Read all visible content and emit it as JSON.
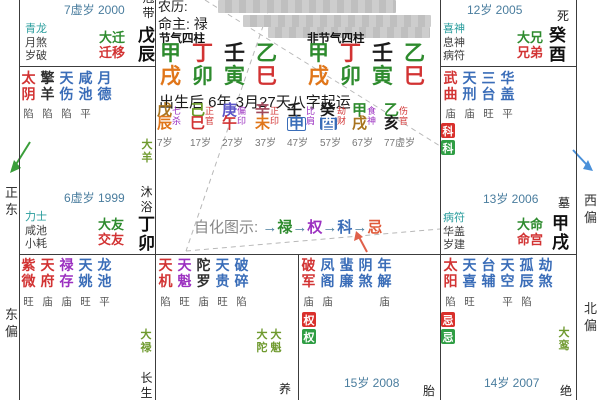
{
  "center": {
    "lunar_label": "农历:",
    "life_master": "命主: 禄",
    "jieqi_header": "节气四柱",
    "non_jieqi_header": "非节气四柱",
    "pillar_stems": [
      "甲",
      "丁",
      "壬",
      "乙"
    ],
    "pillar_branches": [
      "戌",
      "卯",
      "寅",
      "巳"
    ],
    "qiyun_text": "出生后 6年 3月27天八字起运",
    "zihua_label": "自化图示:",
    "arrow": "→",
    "zihua_flow": [
      "禄",
      "权",
      "科",
      "忌"
    ],
    "dayun": [
      {
        "stem": "戊",
        "branch": "辰",
        "god": "七杀",
        "age": "7岁"
      },
      {
        "stem": "己",
        "branch": "巳",
        "god": "正官",
        "age": "17岁"
      },
      {
        "stem": "庚",
        "branch": "午",
        "god": "偏印",
        "age": "27岁"
      },
      {
        "stem": "辛",
        "branch": "未",
        "god": "正印",
        "age": "37岁"
      },
      {
        "stem": "壬",
        "branch": "申",
        "god": "比肩",
        "age": "47岁"
      },
      {
        "stem": "癸",
        "branch": "酉",
        "god": "劫财",
        "age": "57岁"
      },
      {
        "stem": "甲",
        "branch": "戌",
        "god": "食神",
        "age": "67岁"
      },
      {
        "stem": "乙",
        "branch": "亥",
        "god": "伤官",
        "age": "77虚岁"
      }
    ]
  },
  "palaces": {
    "qianyi": {
      "year": "7虚岁 2000",
      "stage": "冠带",
      "gods": [
        "青龙",
        "月煞",
        "岁破"
      ],
      "da": "大迁",
      "name": "迁移",
      "ganzhi": "戊辰"
    },
    "xiongdi": {
      "year": "12岁 2005",
      "stage": "死",
      "gods": [
        "喜神",
        "息神",
        "病符"
      ],
      "da": "大兄",
      "name": "兄弟",
      "ganzhi": "癸酉"
    },
    "jiaoyou": {
      "stars": [
        {
          "n": "太阴",
          "s": "陷"
        },
        {
          "n": "擎羊",
          "s": "陷"
        },
        {
          "n": "天伤",
          "s": "陷"
        },
        {
          "n": "咸池",
          "s": "平"
        },
        {
          "n": "月德",
          "s": ""
        }
      ],
      "flow": "大羊",
      "stage": "沐浴",
      "year": "6虚岁 1999",
      "gods": [
        "力士",
        "咸池",
        "小耗"
      ],
      "da": "大友",
      "name": "交友",
      "ganzhi": "丁卯"
    },
    "ming": {
      "stars": [
        {
          "n": "武曲",
          "s": "庙"
        },
        {
          "n": "天刑",
          "s": "庙"
        },
        {
          "n": "三台",
          "s": "旺"
        },
        {
          "n": "华盖",
          "s": "平"
        }
      ],
      "badges": [
        "科",
        "科"
      ],
      "year": "13岁 2006",
      "stage": "墓",
      "gods": [
        "病符",
        "华盖",
        "岁建"
      ],
      "da": "大命",
      "name": "命宫",
      "ganzhi": "甲戌"
    },
    "ziwei": {
      "stars": [
        {
          "n": "紫微",
          "s": "旺"
        },
        {
          "n": "天府",
          "s": "庙"
        },
        {
          "n": "禄存",
          "s": "庙"
        },
        {
          "n": "天姚",
          "s": "旺"
        },
        {
          "n": "龙池",
          "s": "平"
        }
      ],
      "flow": "大禄",
      "stage": "长生"
    },
    "tianji": {
      "stars": [
        {
          "n": "天机",
          "s": "陷"
        },
        {
          "n": "天魁",
          "s": "旺"
        },
        {
          "n": "陀罗",
          "s": "庙"
        },
        {
          "n": "天贵",
          "s": "旺"
        },
        {
          "n": "破碎",
          "s": "陷"
        }
      ],
      "flows": [
        "大陀",
        "大魁"
      ],
      "stage": "养"
    },
    "pojun": {
      "stars": [
        {
          "n": "破军",
          "s": "庙"
        },
        {
          "n": "凤阁",
          "s": "庙"
        },
        {
          "n": "蜚廉",
          "s": ""
        },
        {
          "n": "阴煞",
          "s": ""
        },
        {
          "n": "年解",
          "s": "庙"
        }
      ],
      "badges": [
        "权",
        "权"
      ],
      "year": "15岁 2008",
      "stage": "胎"
    },
    "taiyang": {
      "stars": [
        {
          "n": "太阳",
          "s": "陷"
        },
        {
          "n": "天喜",
          "s": "旺"
        },
        {
          "n": "台辅",
          "s": ""
        },
        {
          "n": "天空",
          "s": "平"
        },
        {
          "n": "孤辰",
          "s": "陷"
        },
        {
          "n": "劫煞",
          "s": ""
        }
      ],
      "badges": [
        "忌",
        "忌"
      ],
      "flow": "大鸾",
      "year": "14岁 2007",
      "stage": "绝"
    }
  },
  "compass": {
    "left_mid": "正东",
    "left_bottom": "东偏",
    "right_mid": "西偏",
    "right_bottom": "北偏"
  },
  "colors": {
    "main_star": "#d23333",
    "minor_star": "#3a6db8",
    "lucun_star": "#9b30c0",
    "palace_green": "#2e8b2e",
    "palace_red": "#d23333",
    "badge_red": "#d9302c",
    "badge_green": "#2f9e44",
    "year_text": "#4a7d9e",
    "first_god_teal": "#2a9d9d",
    "flow_star": "#6f9a2f"
  }
}
